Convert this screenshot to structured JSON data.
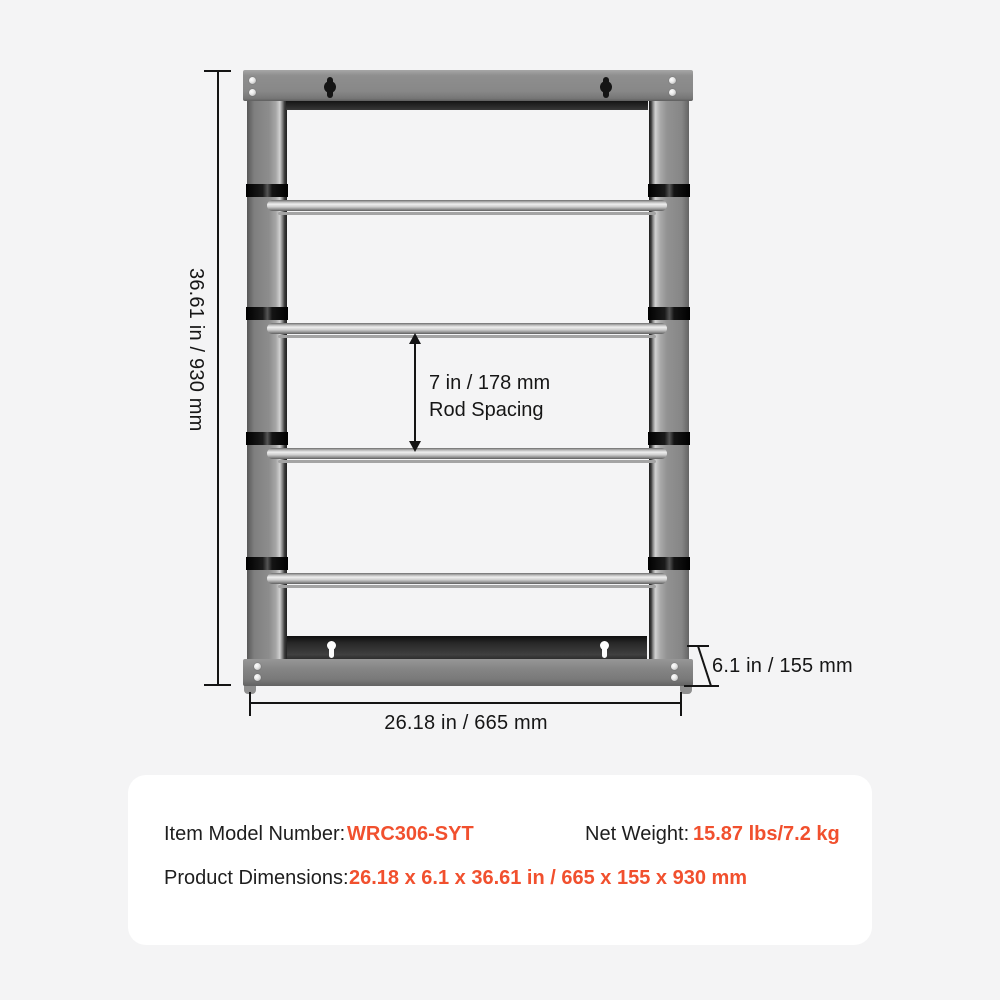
{
  "dimensions": {
    "height": "36.61 in / 930 mm",
    "width": "26.18 in / 665 mm",
    "depth": "6.1 in / 155 mm",
    "rod_spacing_value": "7 in / 178 mm",
    "rod_spacing_caption": "Rod Spacing"
  },
  "info": {
    "model_label": "Item Model Number:",
    "model_value": "WRC306-SYT",
    "weight_label": "Net Weight:",
    "weight_value": "15.87 lbs/7.2 kg",
    "dimensions_label": "Product Dimensions:",
    "dimensions_value": "26.18 x 6.1 x 36.61 in / 665 x 155 x 930 mm"
  },
  "colors": {
    "accent": "#F1502E",
    "line": "#141414",
    "frame_gray": "#8a8a8a"
  }
}
